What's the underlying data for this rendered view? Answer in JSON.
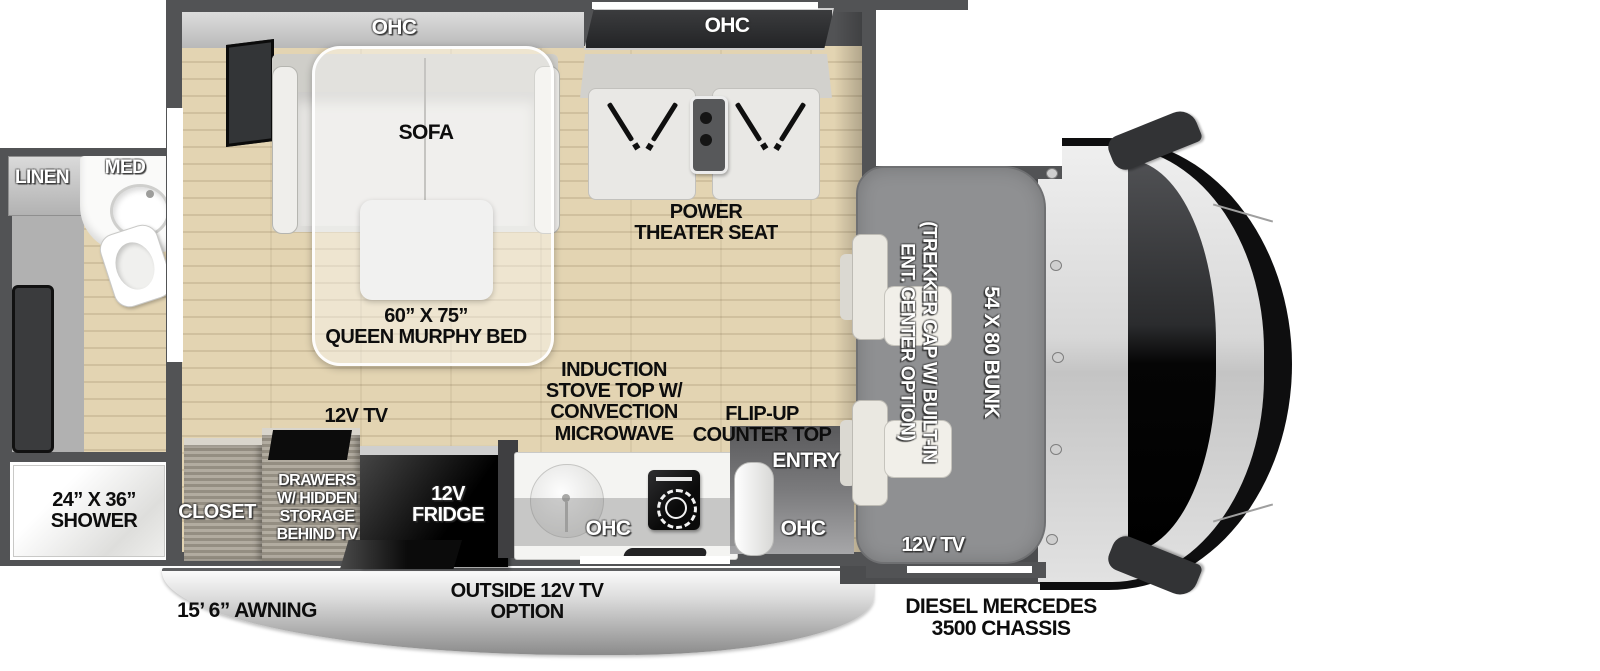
{
  "labels": {
    "linen": "LINEN",
    "med": "MED",
    "ohc": "OHC",
    "sofa": "SOFA",
    "theater_seat": "POWER\nTHEATER SEAT",
    "murphy_bed": "60” X 75”\nQUEEN MURPHY BED",
    "kitchen_tv": "12V TV",
    "stove": "INDUCTION\nSTOVE TOP W/\nCONVECTION\nMICROWAVE",
    "flip_up_counter": "FLIP-UP\nCOUNTER TOP",
    "entry": "ENTRY",
    "shower": "24” X 36”\nSHOWER",
    "closet": "CLOSET",
    "drawers": "DRAWERS\nW/ HIDDEN\nSTORAGE\nBEHIND TV",
    "fridge": "12V\nFRIDGE",
    "trekker_cap": "(TREKKER CAP W/ BUILT-IN\nENT. CENTER OPTION)",
    "bunk": "54 X 80 BUNK",
    "bunk_tv": "12V TV",
    "awning": "15’ 6” AWNING",
    "outside_tv": "OUTSIDE 12V TV\nOPTION",
    "chassis": "DIESEL MERCEDES\n3500 CHASSIS"
  },
  "colors": {
    "wall": "#525355",
    "floor": "#e3d4b2",
    "cabinet": "#a59e91",
    "bunk": "#8f9092",
    "cabfloor": "#4b4c4e",
    "seat": "#eae8e1",
    "counter": "#f4f4f2",
    "ink": "#0d0d0d",
    "awning_hi": "#fbfbfb",
    "awning_lo": "#8b8b8b"
  }
}
